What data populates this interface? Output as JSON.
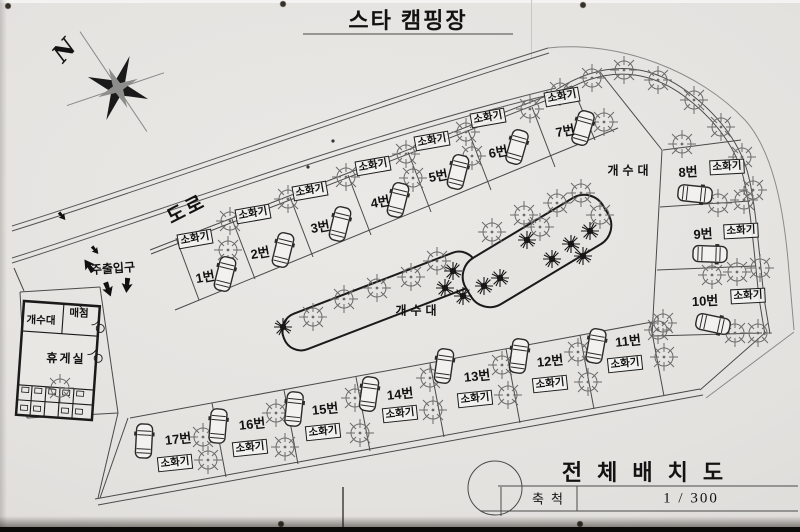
{
  "labels": {
    "title": "스타 캠핑장",
    "north": "N",
    "road": "도로",
    "entrance": "주출입구",
    "extinguisher": "소화기",
    "sink_upper": "개수대",
    "sink_center": "개수대",
    "building_sink": "개수대",
    "building_store": "매점",
    "building_lounge": "휴게실"
  },
  "title_block": {
    "title": "전체배치도",
    "scale_label": "축척",
    "scale_value": "1 / 300"
  },
  "sites": [
    {
      "label": "1번",
      "x": 205,
      "y": 276,
      "ext_x": 195,
      "ext_y": 239,
      "rot": -10
    },
    {
      "label": "2번",
      "x": 260,
      "y": 252,
      "ext_x": 253,
      "ext_y": 214,
      "rot": -10
    },
    {
      "label": "3번",
      "x": 320,
      "y": 226,
      "ext_x": 310,
      "ext_y": 191,
      "rot": -10
    },
    {
      "label": "4번",
      "x": 380,
      "y": 201,
      "ext_x": 373,
      "ext_y": 166,
      "rot": -10
    },
    {
      "label": "5번",
      "x": 438,
      "y": 175,
      "ext_x": 432,
      "ext_y": 141,
      "rot": -10
    },
    {
      "label": "6번",
      "x": 498,
      "y": 151,
      "ext_x": 488,
      "ext_y": 118,
      "rot": -10
    },
    {
      "label": "7번",
      "x": 565,
      "y": 130,
      "ext_x": 562,
      "ext_y": 97,
      "rot": -10
    },
    {
      "label": "8번",
      "x": 688,
      "y": 171,
      "ext_x": 727,
      "ext_y": 167,
      "rot": -3
    },
    {
      "label": "9번",
      "x": 703,
      "y": 233,
      "ext_x": 741,
      "ext_y": 231,
      "rot": -3
    },
    {
      "label": "10번",
      "x": 705,
      "y": 300,
      "ext_x": 748,
      "ext_y": 296,
      "rot": -3
    },
    {
      "label": "11번",
      "x": 628,
      "y": 340,
      "ext_x": 625,
      "ext_y": 364,
      "rot": -6
    },
    {
      "label": "12번",
      "x": 550,
      "y": 360,
      "ext_x": 550,
      "ext_y": 384,
      "rot": -6
    },
    {
      "label": "13번",
      "x": 477,
      "y": 375,
      "ext_x": 475,
      "ext_y": 399,
      "rot": -6
    },
    {
      "label": "14번",
      "x": 400,
      "y": 393,
      "ext_x": 400,
      "ext_y": 414,
      "rot": -6
    },
    {
      "label": "15번",
      "x": 325,
      "y": 408,
      "ext_x": 323,
      "ext_y": 432,
      "rot": -6
    },
    {
      "label": "16번",
      "x": 252,
      "y": 423,
      "ext_x": 250,
      "ext_y": 448,
      "rot": -6
    },
    {
      "label": "17번",
      "x": 178,
      "y": 438,
      "ext_x": 175,
      "ext_y": 463,
      "rot": -6
    }
  ],
  "colors": {
    "line": "#4a4a4a",
    "ink": "#111111",
    "bed_outline": "#1a1a1a"
  }
}
